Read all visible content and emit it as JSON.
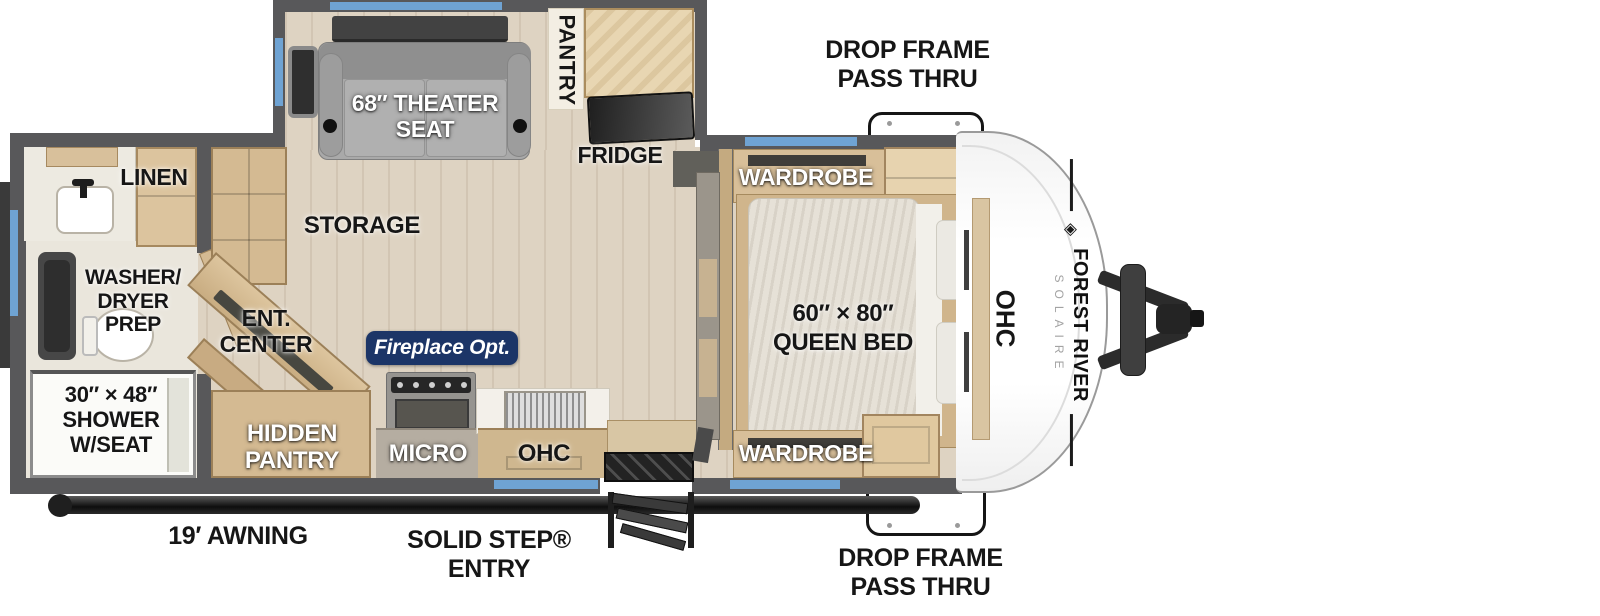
{
  "brand": {
    "name": "FOREST RIVER",
    "model": "SOLAIRE"
  },
  "labels": {
    "drop_frame_top": [
      "DROP FRAME",
      "PASS THRU"
    ],
    "drop_frame_bottom": [
      "DROP FRAME",
      "PASS THRU"
    ],
    "awning": "19′ AWNING",
    "solid_step": [
      "SOLID STEP®",
      "ENTRY"
    ],
    "theater": [
      "68″ THEATER",
      "SEAT"
    ],
    "pantry": "PANTRY",
    "fridge": "FRIDGE",
    "storage": "STORAGE",
    "linen": "LINEN",
    "washer": [
      "WASHER/",
      "DRYER",
      "PREP"
    ],
    "shower": [
      "30″ × 48″",
      "SHOWER",
      "W/SEAT"
    ],
    "ent_center": [
      "ENT.",
      "CENTER"
    ],
    "fireplace": "Fireplace Opt.",
    "hidden_pantry": [
      "HIDDEN",
      "PANTRY"
    ],
    "micro": "MICRO",
    "ohc_kitchen": "OHC",
    "wardrobe_top": "WARDROBE",
    "wardrobe_bottom": "WARDROBE",
    "bed": [
      "60″ × 80″",
      "QUEEN BED"
    ],
    "ohc_bedroom": "OHC",
    "logo_glyph": "◈"
  },
  "colors": {
    "wall": "#58585a",
    "floor": "#ded3c2",
    "bath_floor": "#eae6dc",
    "cabinet": "#d4ba92",
    "cabinet_light": "#e8d6b2",
    "window_accent": "#6fa3d3",
    "fireplace_badge": "#1c3567",
    "label_dark": "#161616",
    "sofa_gray": "#a9a9a9",
    "appliance_dark": "#3a3a3a"
  }
}
